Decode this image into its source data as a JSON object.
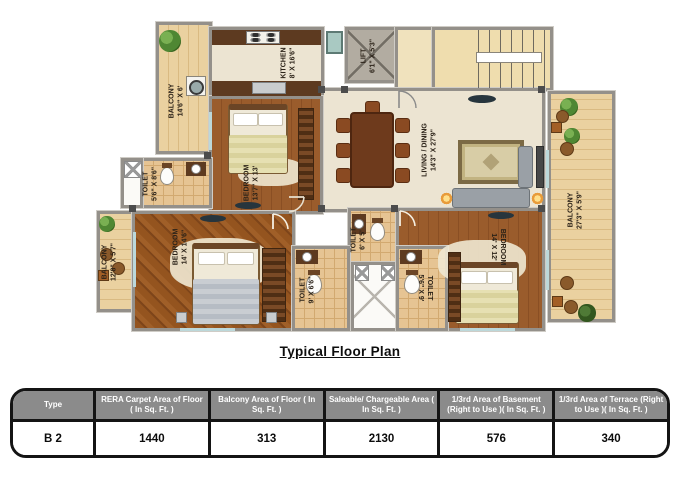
{
  "title": "Typical Floor Plan",
  "plan": {
    "rooms": {
      "balcony_top": {
        "name": "BALCONY",
        "dims": "14'6\" X 6'"
      },
      "kitchen": {
        "name": "KITCHEN",
        "dims": "8' X 16'6\""
      },
      "lift": {
        "name": "LIFT",
        "dims": "6'1\" X 5'3\""
      },
      "living": {
        "name": "LIVING / DINING",
        "dims": "14'3\" X 27'9\""
      },
      "bedroom1": {
        "name": "BEDROOM",
        "dims": "13'7\" X 13'"
      },
      "toilet1": {
        "name": "TOILET",
        "dims": "5'6\" X 8'6\""
      },
      "balcony_left": {
        "name": "BALCONY",
        "dims": "12'8\" X 5'7\""
      },
      "bedroom2": {
        "name": "BEDROOM",
        "dims": "14' X 14'6\""
      },
      "toilet2": {
        "name": "TOILET",
        "dims": "9' X 6'6\""
      },
      "toilet3": {
        "name": "TOILET",
        "dims": "6' X 5'"
      },
      "toilet4": {
        "name": "TOILET",
        "dims": "5'6\" X 9'"
      },
      "bedroom3": {
        "name": "BEDROOM",
        "dims": "14' X 12'"
      },
      "balcony_right": {
        "name": "BALCONY",
        "dims": "27'3\" X 5'9\""
      }
    }
  },
  "table": {
    "headers": [
      "Type",
      "RERA Carpet Area of Floor ( In Sq. Ft. )",
      "Balcony Area of Floor ( In Sq. Ft. )",
      "Saleable/ Chargeable Area ( In Sq. Ft. )",
      "1/3rd Area of Basement (Right to Use )( In Sq. Ft. )",
      "1/3rd Area of Terrace (Right to Use )( In Sq. Ft. )"
    ],
    "rows": [
      [
        "B 2",
        "1440",
        "313",
        "2130",
        "576",
        "340"
      ]
    ]
  },
  "colors": {
    "wall": "#94908a",
    "living_floor": "#ece4d2",
    "bedroom_wood": "#9a5c2c",
    "balcony_wood": "#ead1a0",
    "toilet_tile": "#e6c493",
    "table_header_bg": "#8b8b8b",
    "table_border": "#141414",
    "plant_green": "#4f8733"
  }
}
